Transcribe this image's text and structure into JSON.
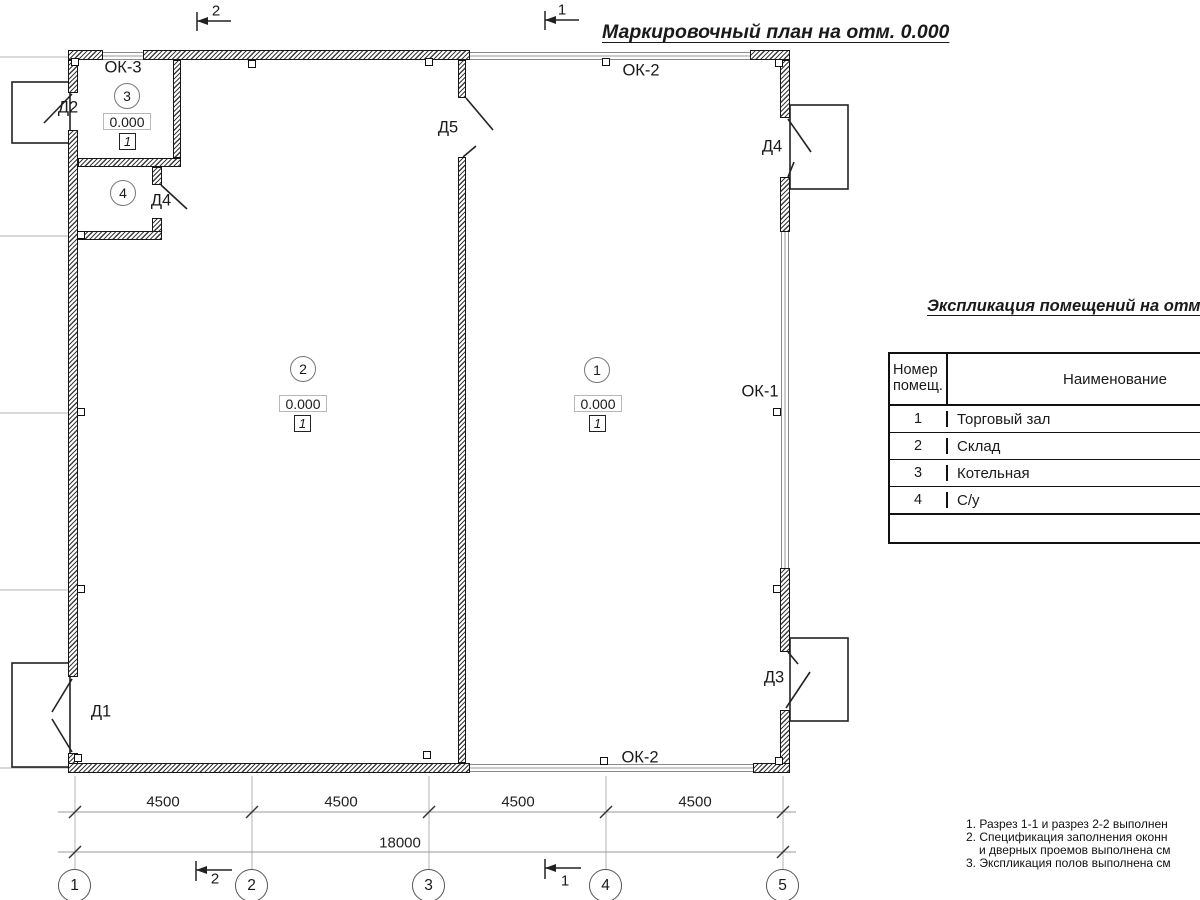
{
  "title": "Маркировочный план на отм. 0.000",
  "section_marks": {
    "top_left": "2",
    "top_right": "1",
    "bottom_left": "2",
    "bottom_right": "1"
  },
  "windows": {
    "ok3": "ОК-3",
    "ok2_top": "ОК-2",
    "ok1": "ОК-1",
    "ok2_bottom": "ОК-2"
  },
  "doors": {
    "d1": "Д1",
    "d2": "Д2",
    "d3": "Д3",
    "d4_entrance": "Д4",
    "d4_wc": "Д4",
    "d5": "Д5"
  },
  "rooms": {
    "r1": {
      "number": "1",
      "elevation": "0.000",
      "floor_type": "1"
    },
    "r2": {
      "number": "2",
      "elevation": "0.000",
      "floor_type": "1"
    },
    "r3": {
      "number": "3",
      "elevation": "0.000",
      "floor_type": "1"
    },
    "r4": {
      "number": "4"
    }
  },
  "dimensions": {
    "segments": [
      "4500",
      "4500",
      "4500",
      "4500"
    ],
    "total": "18000"
  },
  "axes": [
    "1",
    "2",
    "3",
    "4",
    "5"
  ],
  "schedule_table": {
    "title": "Экспликация помещений на отм. 0.000",
    "col_number_line1": "Номер",
    "col_number_line2": "помещ.",
    "col_name": "Наименование",
    "rows": [
      {
        "num": "1",
        "name": "Торговый зал"
      },
      {
        "num": "2",
        "name": "Склад"
      },
      {
        "num": "3",
        "name": "Котельная"
      },
      {
        "num": "4",
        "name": "С/у"
      }
    ]
  },
  "notes": [
    "1. Разрез 1-1 и разрез 2-2 выполнен",
    "2. Спецификация заполнения оконн",
    "и дверных проемов выполнена см",
    "3. Экспликация полов выполнена см"
  ]
}
